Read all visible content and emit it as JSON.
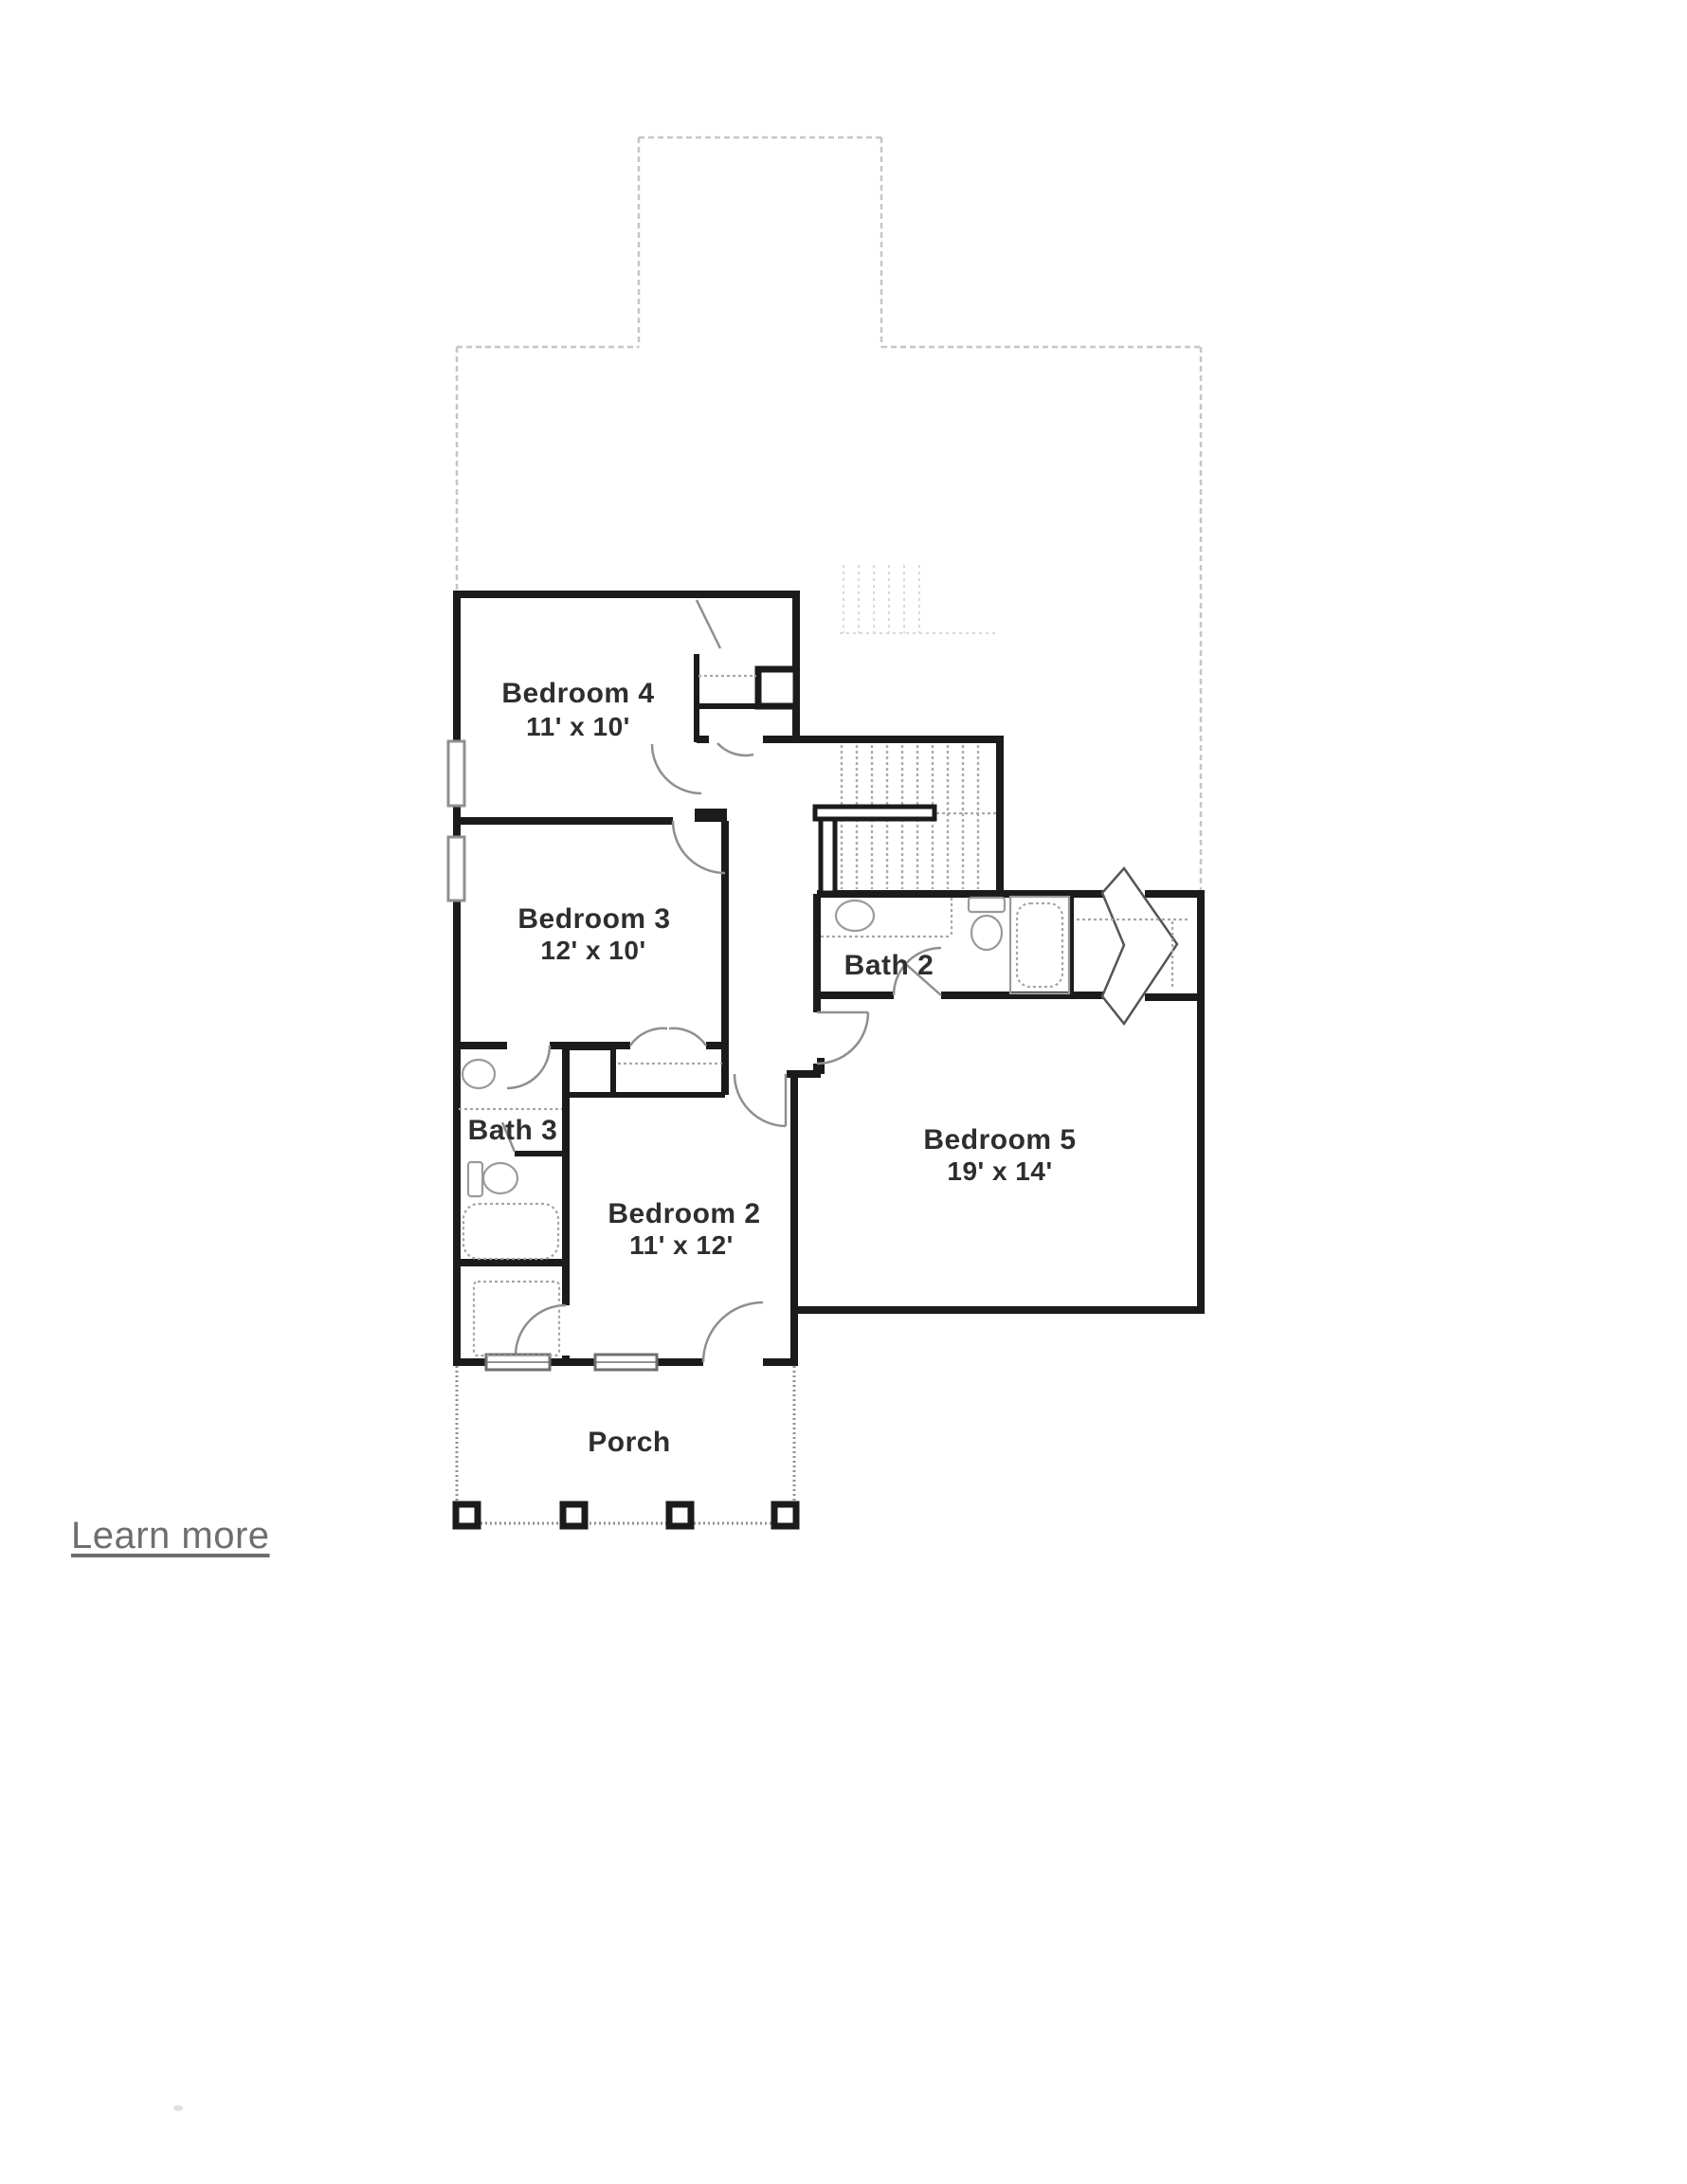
{
  "page": {
    "background": "#ffffff"
  },
  "plan": {
    "rooms": [
      {
        "name": "Bedroom 4",
        "dimensions": "11' x 10'"
      },
      {
        "name": "Bedroom 3",
        "dimensions": "12' x 10'"
      },
      {
        "name": "Bedroom 2",
        "dimensions": "11' x 12'"
      },
      {
        "name": "Bedroom 5",
        "dimensions": "19' x 14'"
      },
      {
        "name": "Bath 2",
        "dimensions": ""
      },
      {
        "name": "Bath 3",
        "dimensions": ""
      },
      {
        "name": "Porch",
        "dimensions": ""
      }
    ],
    "colors": {
      "wall": "#1b1b1b",
      "faint_outline": "#c6c6c6",
      "fixture": "#9a9a9a",
      "label_text": "#2e2e2e"
    }
  },
  "footer": {
    "learn_more_label": "Learn more"
  }
}
